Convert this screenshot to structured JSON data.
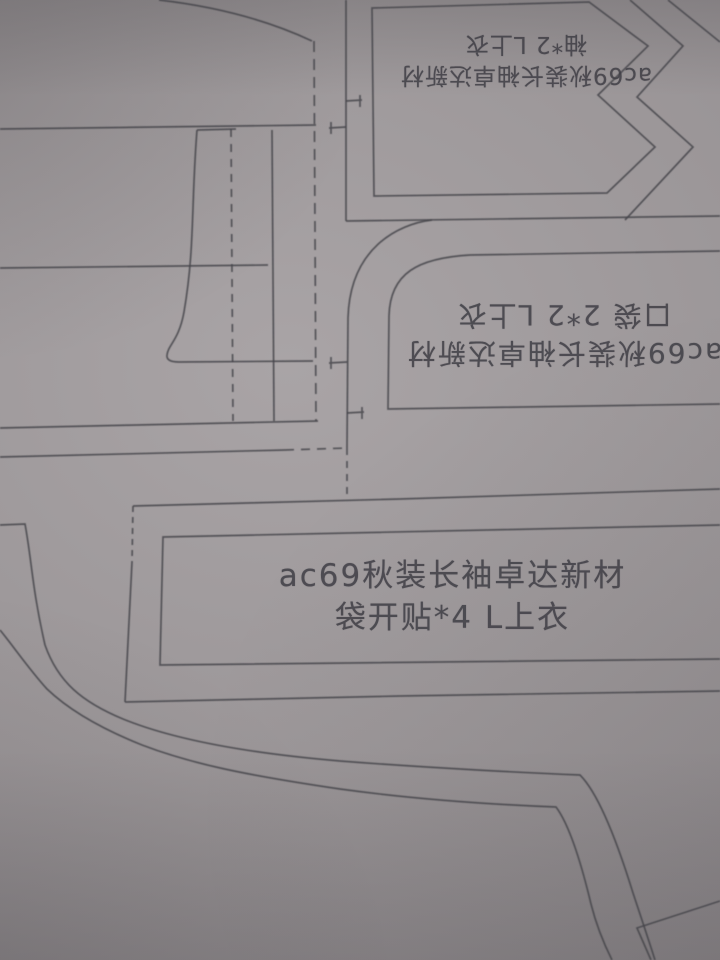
{
  "colors": {
    "paper": "#9b9698",
    "line": "#46454b",
    "text": "#3f3e45"
  },
  "pieces": {
    "sleeve_placket": {
      "title": "ac69秋装长袖卓达新材",
      "spec": "袖*2 L上衣",
      "orientation": "rotated-180"
    },
    "pocket": {
      "title": "ac69秋装长袖卓达新材",
      "spec": "口袋 2*2 L上衣",
      "orientation": "rotated-180"
    },
    "pocket_facing": {
      "title": "ac69秋装长袖卓达新材",
      "spec": "袋开贴*4 L上衣",
      "orientation": "upright"
    }
  }
}
